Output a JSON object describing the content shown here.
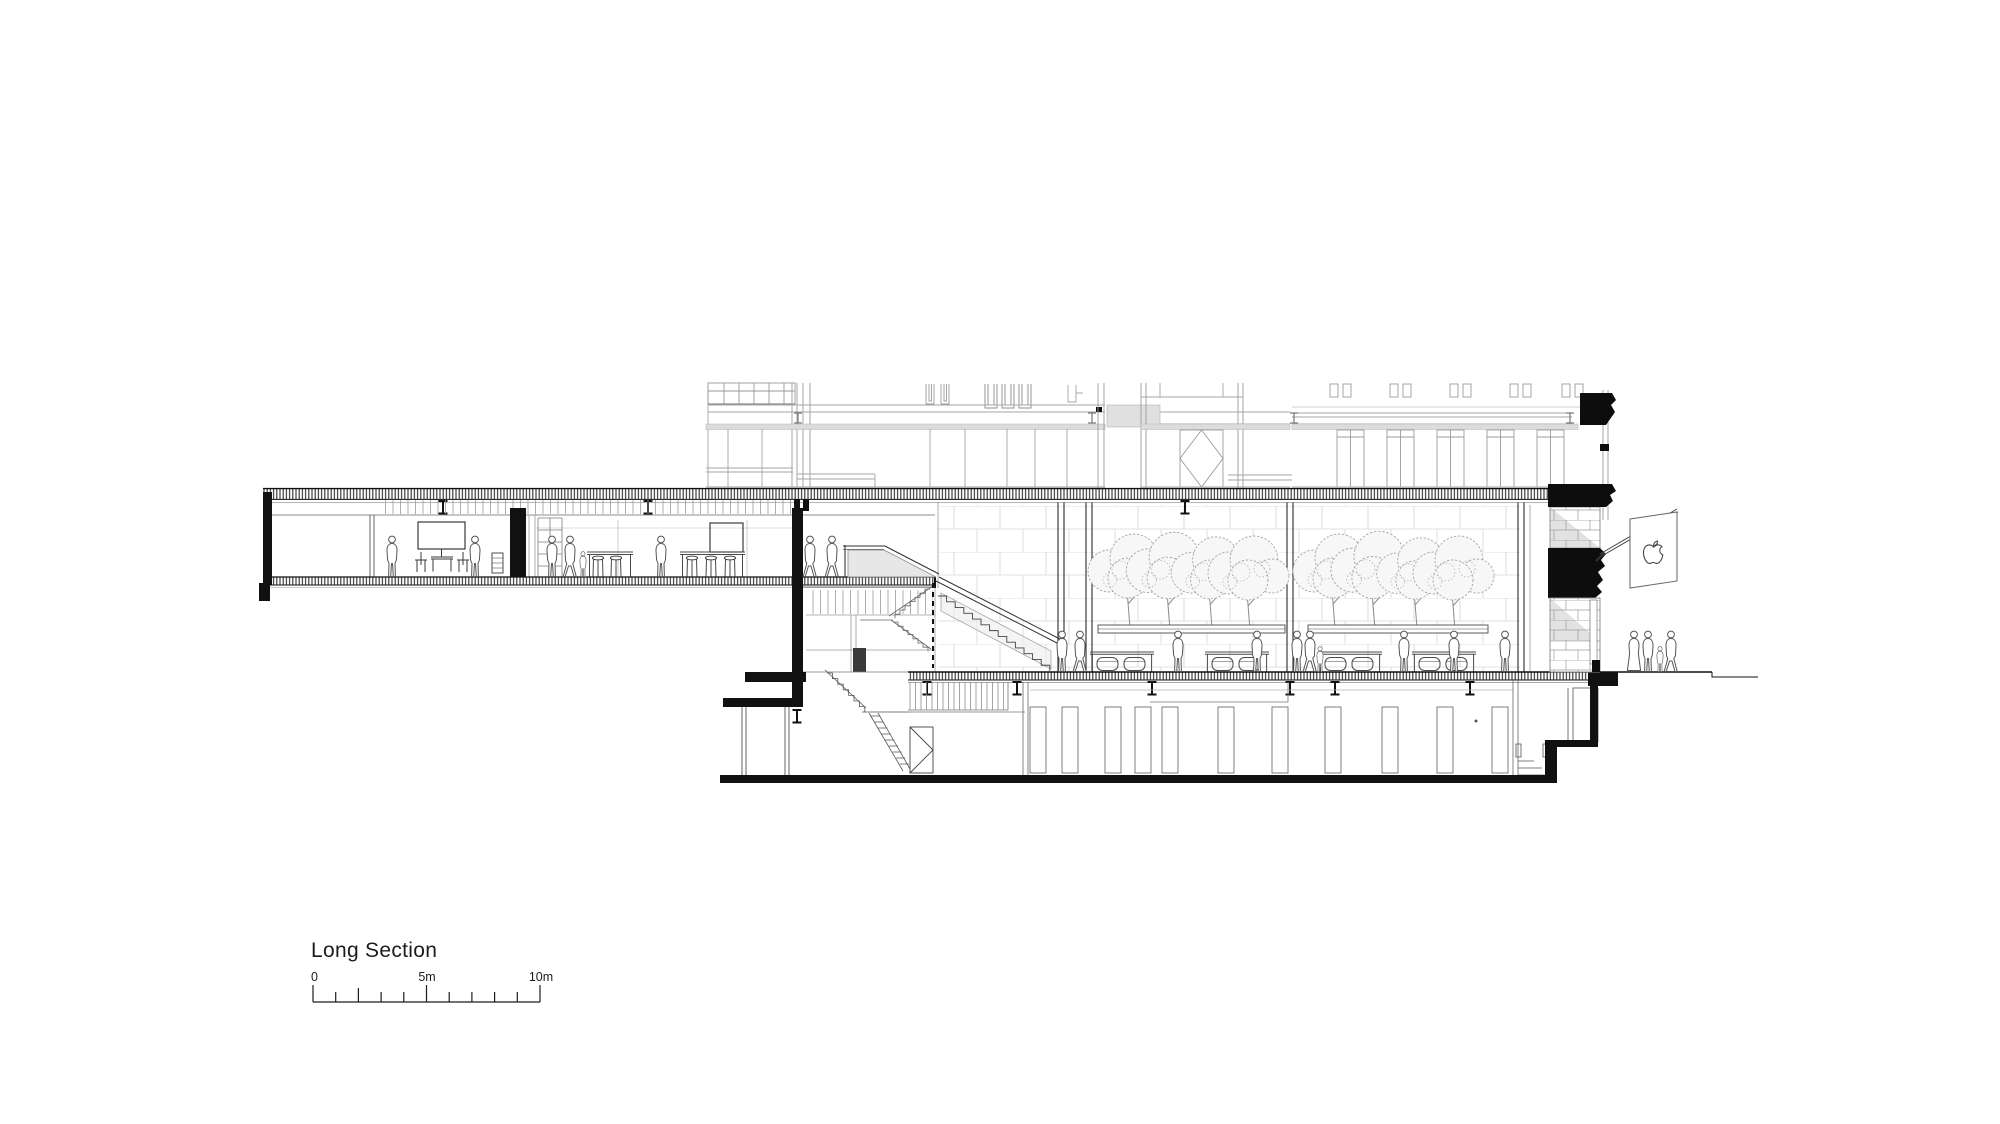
{
  "page": {
    "background_color": "#ffffff"
  },
  "title_block": {
    "title": "Long Section"
  },
  "scale_bar": {
    "start_label": "0",
    "mid_label": "5m",
    "end_label": "10m",
    "total_meters": 10,
    "minor_tick_interval_m": 1,
    "major_tick_positions_m": [
      0,
      5,
      10
    ]
  },
  "drawing": {
    "kind": "architectural-long-section",
    "ink_color": "#111111",
    "existing_building_line_color": "#a6a6a6",
    "stone_joint_color": "#d6d6d6",
    "glass_tint_color": "#e3e3e3",
    "flag_icon": "apple-logo-icon"
  }
}
